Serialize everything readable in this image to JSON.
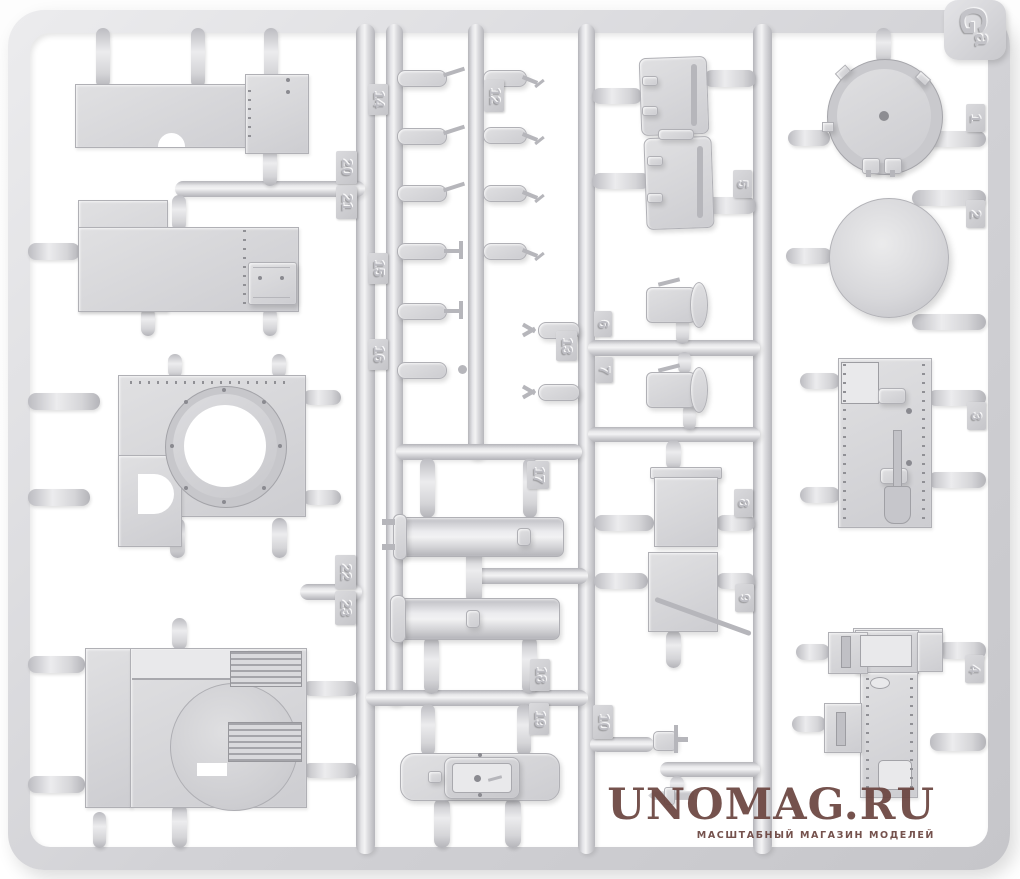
{
  "sprue": {
    "corner_mark": {
      "letter_main": "G",
      "letter_sub": "a"
    },
    "plastic_color": "#d6d6d9",
    "part_tags": [
      {
        "label": "1",
        "x": 966,
        "y": 104,
        "w": 19,
        "h": 28
      },
      {
        "label": "2",
        "x": 966,
        "y": 200,
        "w": 19,
        "h": 28
      },
      {
        "label": "3",
        "x": 967,
        "y": 402,
        "w": 19,
        "h": 28
      },
      {
        "label": "4",
        "x": 965,
        "y": 655,
        "w": 19,
        "h": 28
      },
      {
        "label": "5",
        "x": 733,
        "y": 170,
        "w": 19,
        "h": 28
      },
      {
        "label": "6",
        "x": 594,
        "y": 311,
        "w": 18,
        "h": 26
      },
      {
        "label": "7",
        "x": 595,
        "y": 357,
        "w": 18,
        "h": 26
      },
      {
        "label": "8",
        "x": 734,
        "y": 489,
        "w": 19,
        "h": 28
      },
      {
        "label": "9",
        "x": 735,
        "y": 584,
        "w": 19,
        "h": 28
      },
      {
        "label": "10",
        "x": 593,
        "y": 705,
        "w": 20,
        "h": 34
      },
      {
        "label": "12",
        "x": 484,
        "y": 80,
        "w": 20,
        "h": 32
      },
      {
        "label": "13",
        "x": 556,
        "y": 331,
        "w": 21,
        "h": 30
      },
      {
        "label": "14",
        "x": 368,
        "y": 84,
        "w": 20,
        "h": 31
      },
      {
        "label": "15",
        "x": 368,
        "y": 253,
        "w": 20,
        "h": 31
      },
      {
        "label": "16",
        "x": 368,
        "y": 339,
        "w": 20,
        "h": 31
      },
      {
        "label": "17",
        "x": 527,
        "y": 461,
        "w": 22,
        "h": 28
      },
      {
        "label": "18",
        "x": 530,
        "y": 659,
        "w": 20,
        "h": 32
      },
      {
        "label": "19",
        "x": 529,
        "y": 703,
        "w": 20,
        "h": 32
      },
      {
        "label": "20",
        "x": 336,
        "y": 151,
        "w": 21,
        "h": 33
      },
      {
        "label": "21",
        "x": 336,
        "y": 186,
        "w": 21,
        "h": 33
      },
      {
        "label": "22",
        "x": 335,
        "y": 555,
        "w": 21,
        "h": 34
      },
      {
        "label": "23",
        "x": 335,
        "y": 591,
        "w": 21,
        "h": 34
      }
    ]
  },
  "watermark": {
    "title": "UNOMAG.RU",
    "subtitle": "МАСШТАБНЫЙ МАГАЗИН МОДЕЛЕЙ",
    "color": "#6b4540"
  }
}
